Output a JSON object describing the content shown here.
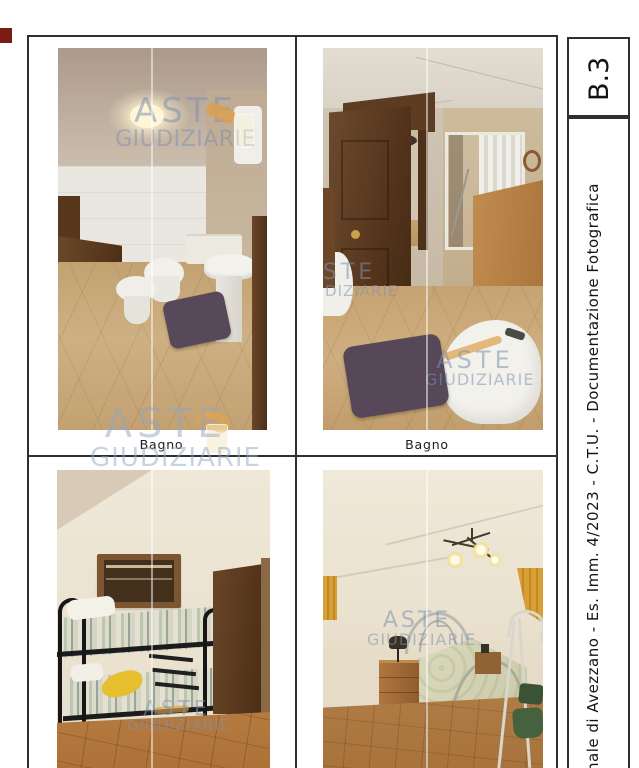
{
  "document": {
    "sheet_code": "B.3",
    "side_caption": "nale di Avezzano  -  Es. Imm. 4/2023  -  C.T.U.  -  Documentazione Fotografica"
  },
  "captions": {
    "top_left": "Bagno",
    "top_right": "Bagno"
  },
  "watermark": {
    "line1": "ASTE",
    "line2": "GIUDIZIARIE"
  },
  "colors": {
    "frame": "#2f2f2f",
    "watermark_blue": "#7e91b0",
    "watermark_orange": "#dd9f4b",
    "rug_purple": "#57485a",
    "floor_tan": "#c6a372",
    "floor_terracotta": "#b5793f",
    "wood_dark": "#5a3a20",
    "wall_cream": "#ece4d3",
    "pillow_yellow": "#e7bf2e",
    "curtain_orange": "#d89f35",
    "scan_mark_red": "#7a1c12"
  }
}
